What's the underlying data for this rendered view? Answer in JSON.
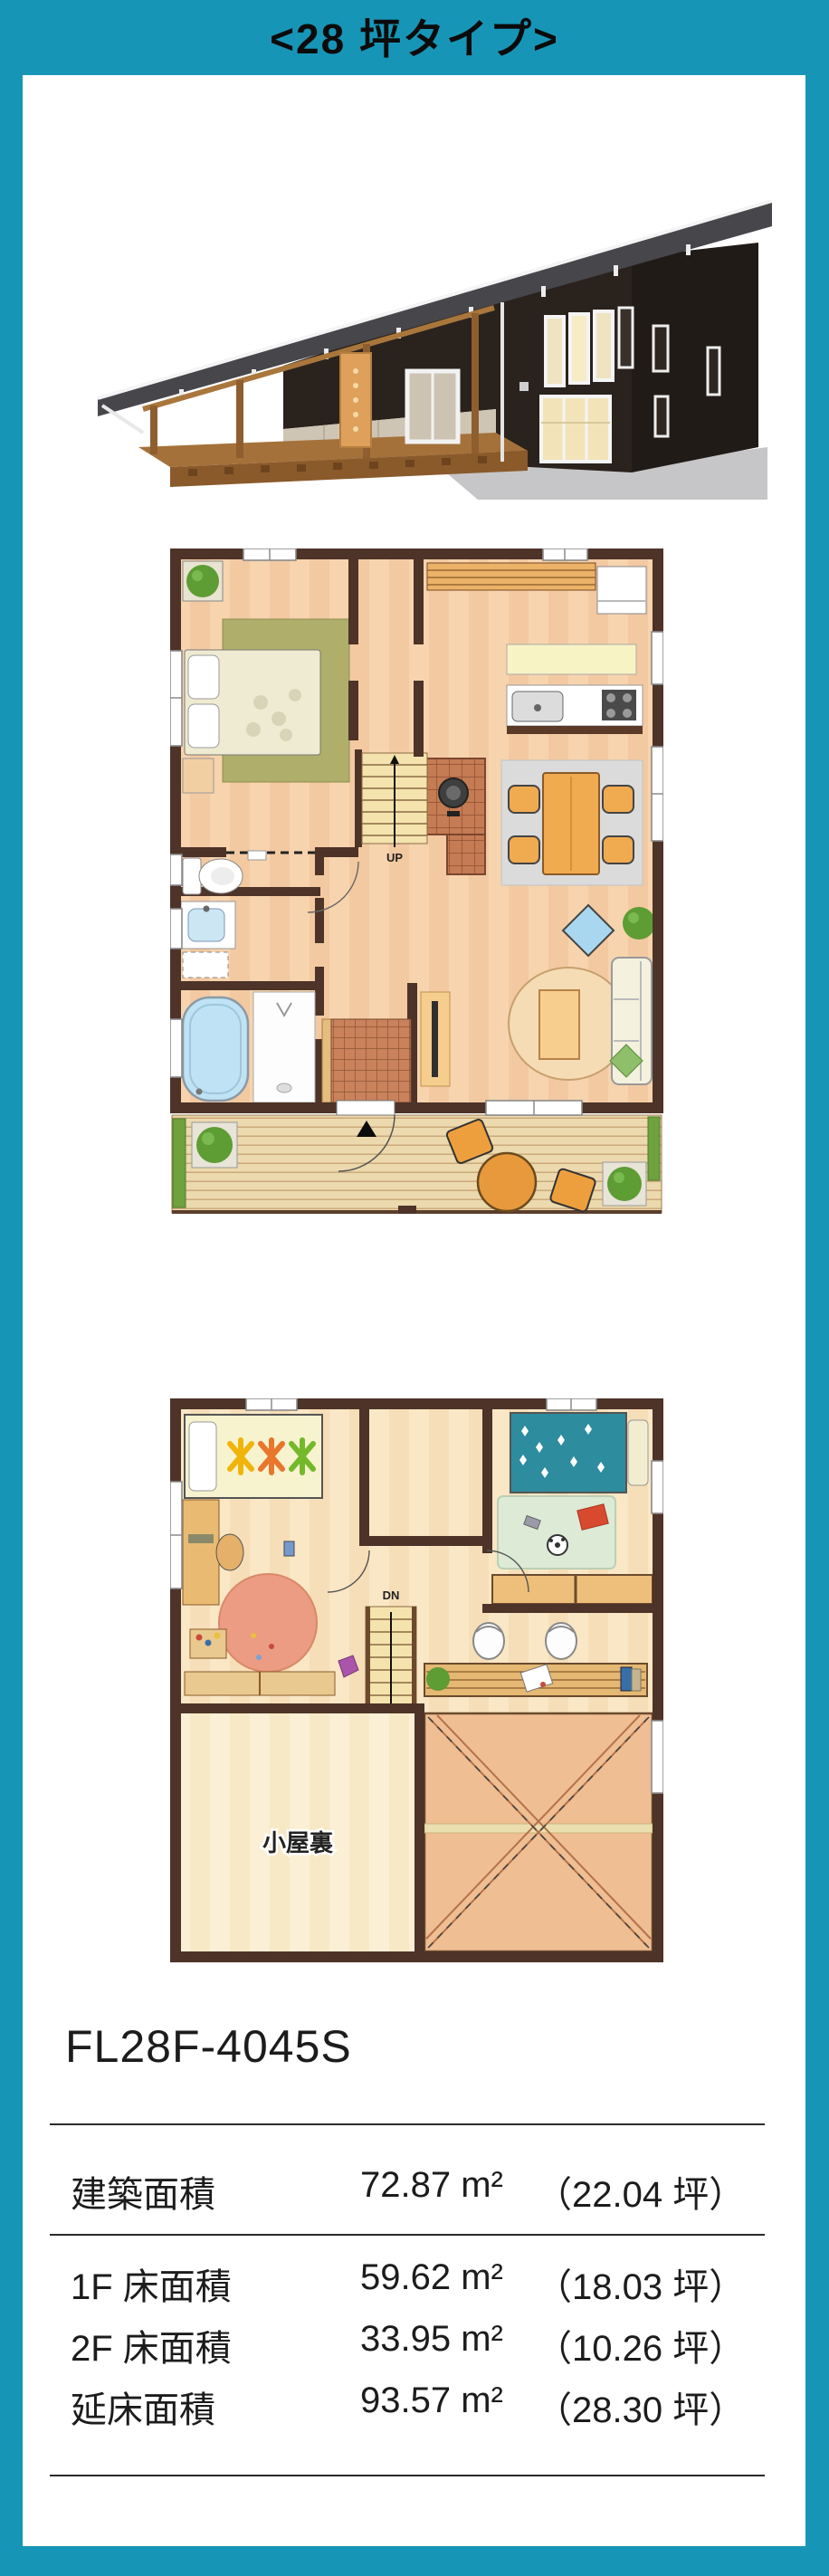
{
  "header": {
    "title": "<28 坪タイプ>"
  },
  "model": {
    "code": "FL28F-4045S"
  },
  "specs": {
    "rows": [
      {
        "label": "建築面積",
        "area": "72.87 m²",
        "tsubo": "（22.04 坪）"
      },
      {
        "label": "1F 床面積",
        "area": "59.62 m²",
        "tsubo": "（18.03 坪）"
      },
      {
        "label": "2F 床面積",
        "area": "33.95 m²",
        "tsubo": "（10.26 坪）"
      },
      {
        "label": "延床面積",
        "area": "93.57 m²",
        "tsubo": "（28.30 坪）"
      }
    ]
  },
  "floorplans": {
    "first": {
      "up_label": "UP"
    },
    "second": {
      "dn_label": "DN",
      "attic_label": "小屋裏"
    }
  },
  "colors": {
    "frame_teal": "#1795B7",
    "wall_brown": "#4D3328",
    "floor_peach": "#F3C9A2",
    "deck_wood": "#ECD9AE",
    "bed_teal": "#2D8C9E",
    "rug_olive": "#AFAE6A"
  }
}
